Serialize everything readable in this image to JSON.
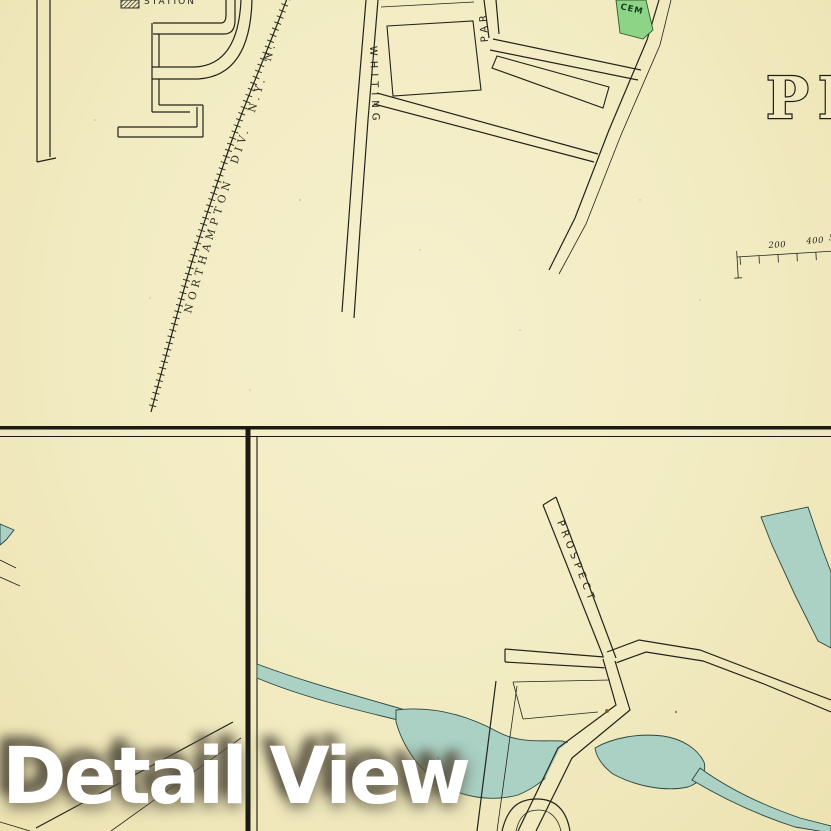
{
  "watermark": "Detail View",
  "top_map": {
    "railroad_label": "NORTHAMPTON DIV. N.Y. N.",
    "whiting_street": "WHITING",
    "park_street_partial": "PAR",
    "cemetery_label": "CEM",
    "map_title_partial": "PI",
    "station_label_partial": "STATION",
    "scale_labels": [
      "200",
      "400",
      "5"
    ]
  },
  "bottom_right_panel": {
    "prospect_street": "PROSPECT",
    "prospect_suffix": "ST."
  },
  "colors": {
    "paper": "#f2ebc2",
    "ink": "#23231a",
    "water_fill": "#abd1c5",
    "water_stroke": "#2a463f",
    "cemetery_fill": "#8ed487",
    "border_ink": "#1b1b12",
    "watermark_color": "#ffffff"
  }
}
